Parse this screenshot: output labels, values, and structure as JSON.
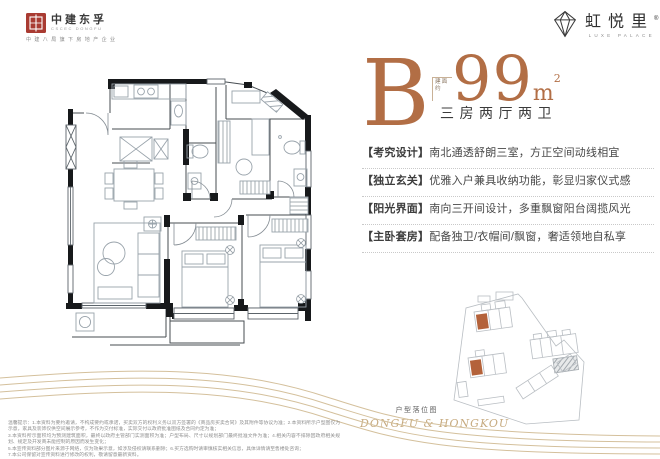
{
  "colors": {
    "accent": "#b26e45",
    "gold_line": "#d4c09c",
    "unit_highlight": "#b4623a",
    "logo_red": "#a93b32",
    "text_dark": "#3b3b3b"
  },
  "developer_logo": {
    "name": "中建东孚",
    "sub": "CSCEC DONGFU",
    "tagline": "中建八局旗下房地产企业"
  },
  "brand_logo": {
    "name": "虹悦里",
    "reg": "®",
    "sub": "LUXE PALACE",
    "icon": "diamond-gem-icon"
  },
  "unit": {
    "type_letter": "B",
    "area_prefix_line1": "建面",
    "area_prefix_line2": "约",
    "area_value": "99",
    "area_unit": "m",
    "area_sup": "2",
    "rooms": "三房两厅两卫"
  },
  "features": [
    {
      "label": "【考究设计】",
      "text": "南北通透舒朗三室，方正空间动线相宜"
    },
    {
      "label": "【独立玄关】",
      "text": "优雅入户兼具收纳功能，彰显归家仪式感"
    },
    {
      "label": "【阳光界面】",
      "text": "南向三开间设计，多重飘窗阳台阔揽风光"
    },
    {
      "label": "【主卧套房】",
      "text": "配备独卫/衣帽间/飘窗，奢适领地自私享"
    }
  ],
  "sitemap": {
    "caption": "户型落位图",
    "watermark": "DONGFU & HONGKOU"
  },
  "disclaimer": {
    "lines": [
      "温馨提示：1.本资料为要约邀请，不构成要约或承诺，买卖双方的权利义务以双方签署的《商品房买卖合同》及其附件等协议为准；2.本资料所示户型图仅为示意，家具及装饰仅供空间展示参考，不作为交付标准，实际交付以政府批准图纸及合同约定为准；",
      "3.本资料所示面积均为预测建筑面积，最终以政府主管部门实测面积为准；户型布局、尺寸以规划部门最终批准文件为准；4.相关内容不排除因政府相关规划、规定及开发商未能控制的原因而发生变化；",
      "5.本宣传资料部分图片来源于网络，仅为效果示意，如涉及侵权请联系删除；6.买方选购时请审慎核实相关信息，具体详情请至售楼处咨询；",
      "7.本公司保留对宣传资料进行修改的权利，敬请留意最新资料。"
    ]
  }
}
